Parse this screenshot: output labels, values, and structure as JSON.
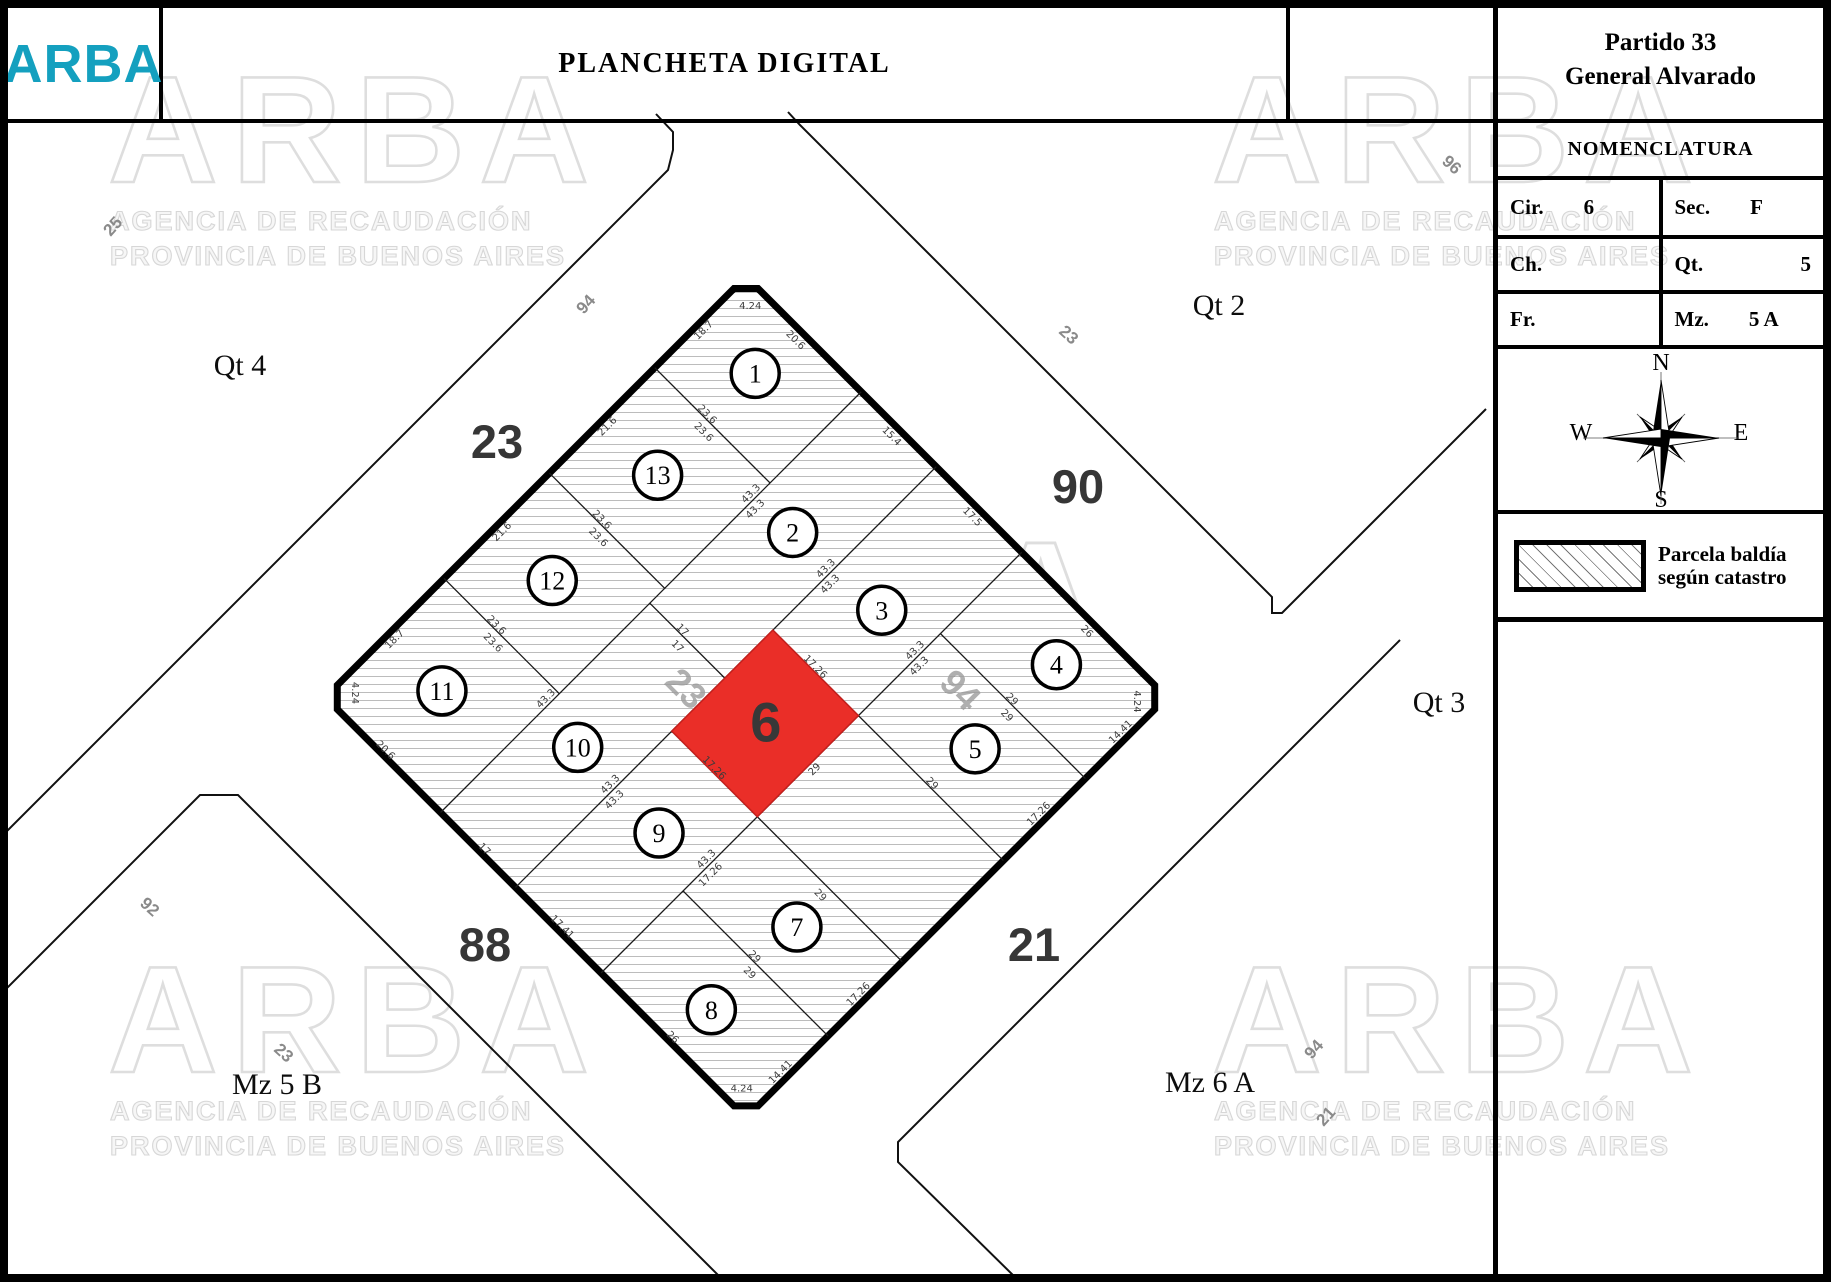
{
  "header": {
    "logo": "ARBA",
    "logo_color": "#14a0bf",
    "title": "PLANCHETA DIGITAL"
  },
  "sidebar": {
    "partido_line1": "Partido 33",
    "partido_line2": "General Alvarado",
    "nomenclatura_title": "NOMENCLATURA",
    "table": [
      {
        "label": "Cir.",
        "value": "6",
        "align": "left"
      },
      {
        "label": "Sec.",
        "value": "F",
        "align": "left"
      },
      {
        "label": "Ch.",
        "value": "",
        "align": "left"
      },
      {
        "label": "Qt.",
        "value": "5",
        "align": "right"
      },
      {
        "label": "Fr.",
        "value": "",
        "align": "left"
      },
      {
        "label": "Mz.",
        "value": "5 A",
        "align": "left"
      }
    ],
    "compass": {
      "n": "N",
      "s": "S",
      "e": "E",
      "w": "W"
    },
    "legend": {
      "line1": "Parcela baldía",
      "line2": "según catastro"
    }
  },
  "map": {
    "colors": {
      "highlight_red": "#ea2e28",
      "hatch_line": "#6b6b6b",
      "accent_teal": "#14a0bf"
    },
    "watermark": {
      "word": "ARBA",
      "line1": "AGENCIA DE RECAUDACIÓN",
      "line2": "PROVINCIA DE BUENOS AIRES",
      "positions": [
        {
          "x": 108,
          "y": 52,
          "s": 1
        },
        {
          "x": 1212,
          "y": 52,
          "s": 1
        },
        {
          "x": 572,
          "y": 515,
          "s": 1.1
        },
        {
          "x": 108,
          "y": 942,
          "s": 1
        },
        {
          "x": 1212,
          "y": 942,
          "s": 1
        }
      ]
    },
    "street_numbers_large": [
      {
        "t": "23",
        "x": 497,
        "y": 458
      },
      {
        "t": "90",
        "x": 1078,
        "y": 503
      },
      {
        "t": "88",
        "x": 485,
        "y": 961
      },
      {
        "t": "21",
        "x": 1034,
        "y": 961
      }
    ],
    "street_labels_small": [
      {
        "t": "25",
        "x": 117,
        "y": 230,
        "r": -48
      },
      {
        "t": "94",
        "x": 590,
        "y": 308,
        "r": -48
      },
      {
        "t": "23",
        "x": 1065,
        "y": 339,
        "r": 42
      },
      {
        "t": "96",
        "x": 1448,
        "y": 169,
        "r": 42
      },
      {
        "t": "92",
        "x": 146,
        "y": 911,
        "r": 42
      },
      {
        "t": "23",
        "x": 280,
        "y": 1057,
        "r": 42
      },
      {
        "t": "94",
        "x": 1318,
        "y": 1053,
        "r": -48
      },
      {
        "t": "21",
        "x": 1330,
        "y": 1120,
        "r": -48
      }
    ],
    "area_labels": [
      {
        "t": "Qt 4",
        "x": 240,
        "y": 375
      },
      {
        "t": "Qt 2",
        "x": 1219,
        "y": 315
      },
      {
        "t": "Qt 3",
        "x": 1439,
        "y": 712
      },
      {
        "t": "Mz 5 B",
        "x": 277,
        "y": 1094
      },
      {
        "t": "Mz 6 A",
        "x": 1210,
        "y": 1092
      }
    ],
    "neighbor_blocks": [
      {
        "name": "qt4-outline",
        "pts": [
          [
            0,
            838
          ],
          [
            668,
            170
          ],
          [
            673,
            150
          ],
          [
            673,
            132
          ],
          [
            656,
            114
          ]
        ]
      },
      {
        "name": "qt2-qt3-outline",
        "pts": [
          [
            788,
            112
          ],
          [
            800,
            125
          ],
          [
            1272,
            597
          ],
          [
            1272,
            613
          ],
          [
            1282,
            613
          ],
          [
            1377,
            518
          ],
          [
            1486,
            409
          ]
        ]
      },
      {
        "name": "mz5b-outline",
        "pts": [
          [
            0,
            995
          ],
          [
            200,
            795
          ],
          [
            238,
            795
          ],
          [
            725,
            1282
          ]
        ]
      },
      {
        "name": "mz6a-outline",
        "pts": [
          [
            1400,
            640
          ],
          [
            898,
            1142
          ],
          [
            898,
            1162
          ],
          [
            1020,
            1282
          ]
        ]
      }
    ],
    "block": {
      "origin_x": 746,
      "origin_y": 276.5,
      "rotation": 45,
      "side": 595,
      "chamfer": 17,
      "inner_street_labels": [
        {
          "t": "23",
          "x": 249,
          "y": 346
        },
        {
          "t": "94",
          "x": 444,
          "y": 153
        }
      ],
      "parcel_lines": [
        [
          163,
          0,
          163,
          595
        ],
        [
          269,
          0,
          269,
          595
        ],
        [
          390,
          0,
          390,
          595
        ],
        [
          0,
          129,
          163,
          129
        ],
        [
          0,
          278,
          163,
          278
        ],
        [
          0,
          427,
          163,
          427
        ],
        [
          390,
          115,
          595,
          115
        ],
        [
          269,
          231,
          595,
          231
        ],
        [
          269,
          374,
          595,
          374
        ],
        [
          390,
          479,
          595,
          479
        ],
        [
          163,
          299,
          269,
          299
        ]
      ],
      "highlight_parcel": {
        "number": "6",
        "x1": 269,
        "y1": 231,
        "x2": 390,
        "y2": 374,
        "label_x": 330,
        "label_y": 302
      },
      "parcels": [
        {
          "n": "1",
          "x": 75,
          "y": 62
        },
        {
          "n": "2",
          "x": 214,
          "y": 148
        },
        {
          "n": "3",
          "x": 332,
          "y": 140
        },
        {
          "n": "4",
          "x": 494,
          "y": 55
        },
        {
          "n": "5",
          "x": 496,
          "y": 172
        },
        {
          "n": "7",
          "x": 496,
          "y": 424
        },
        {
          "n": "8",
          "x": 494,
          "y": 543
        },
        {
          "n": "9",
          "x": 332,
          "y": 455
        },
        {
          "n": "10",
          "x": 214,
          "y": 452
        },
        {
          "n": "11",
          "x": 78,
          "y": 508
        },
        {
          "n": "12",
          "x": 78,
          "y": 352
        },
        {
          "n": "13",
          "x": 78,
          "y": 203
        }
      ],
      "dimensions": [
        [
          "18.7",
          8,
          68,
          -90
        ],
        [
          "21.6",
          8,
          204,
          -90
        ],
        [
          "21.6",
          8,
          353,
          -90
        ],
        [
          "18.7",
          8,
          505,
          -90
        ],
        [
          "20.6",
          80,
          10,
          0
        ],
        [
          "15.4",
          216,
          10,
          0
        ],
        [
          "17.5",
          330,
          10,
          0
        ],
        [
          "26",
          492,
          10,
          0
        ],
        [
          "14.41",
          587,
          57,
          -90
        ],
        [
          "17.26",
          587,
          173,
          -90
        ],
        [
          "17.26",
          587,
          428,
          -90
        ],
        [
          "14.41",
          587,
          538,
          -90
        ],
        [
          "20.6",
          80,
          590,
          0
        ],
        [
          "17",
          220,
          590,
          0
        ],
        [
          "17.41",
          330,
          590,
          0
        ],
        [
          "26",
          486,
          590,
          0
        ],
        [
          "4.24",
          24,
          18,
          -45
        ],
        [
          "4.24",
          577,
          24,
          45
        ],
        [
          "4.24",
          571,
          577,
          -45
        ],
        [
          "4.24",
          18,
          571,
          45
        ],
        [
          "43.3",
          157,
          150,
          -90
        ],
        [
          "43.3",
          171,
          158,
          -90
        ],
        [
          "43.3",
          157,
          440,
          -90
        ],
        [
          "43.3",
          263,
          150,
          -90
        ],
        [
          "43.3",
          277,
          158,
          -90
        ],
        [
          "43.3",
          263,
          455,
          -90
        ],
        [
          "43.3",
          277,
          463,
          -90
        ],
        [
          "43.3",
          384,
          145,
          -90
        ],
        [
          "43.3",
          398,
          153,
          -90
        ],
        [
          "43.3",
          384,
          440,
          -90
        ],
        [
          "17.26",
          398,
          448,
          -90
        ],
        [
          "23.6",
          70,
          125,
          0
        ],
        [
          "23.6",
          80,
          140,
          0
        ],
        [
          "23.6",
          70,
          274,
          0
        ],
        [
          "23.6",
          80,
          289,
          0
        ],
        [
          "23.6",
          70,
          423,
          0
        ],
        [
          "23.6",
          80,
          438,
          0
        ],
        [
          "29",
          487,
          111,
          0
        ],
        [
          "29",
          495,
          126,
          0
        ],
        [
          "29",
          490,
          227,
          0
        ],
        [
          "17.26",
          325,
          227,
          0
        ],
        [
          "17.26",
          325,
          370,
          0
        ],
        [
          "29",
          490,
          385,
          0
        ],
        [
          "29",
          487,
          475,
          0
        ],
        [
          "29",
          495,
          490,
          0
        ],
        [
          "17",
          205,
          295,
          0
        ],
        [
          "17",
          213,
          310,
          0
        ],
        [
          "29",
          397,
          300,
          -90
        ]
      ]
    }
  }
}
